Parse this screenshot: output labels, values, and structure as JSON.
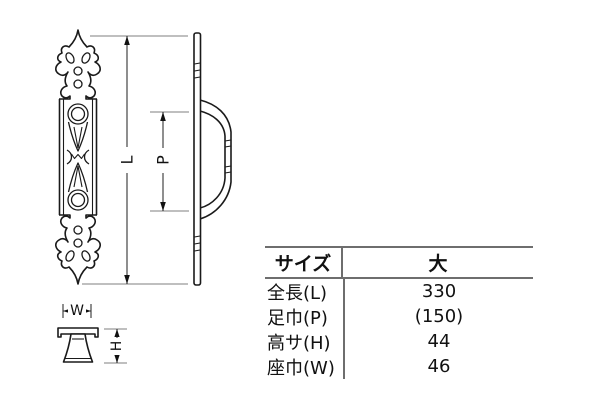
{
  "drawing": {
    "labels": {
      "length": "L",
      "pitch": "P",
      "width": "W",
      "height": "H"
    },
    "views": {
      "front": "front-view-ornate-plate",
      "side": "side-view-with-handle",
      "section": "cross-section-view"
    },
    "colors": {
      "ink": "#1a1a1a",
      "dimension_line": "#333333",
      "extension_line": "#999999",
      "table_rule": "#6e6e6e",
      "background": "#ffffff"
    }
  },
  "table": {
    "header": {
      "size_label": "サイズ",
      "size_value": "大"
    },
    "rows": [
      {
        "label": "全長(L)",
        "value": "330"
      },
      {
        "label": "足巾(P)",
        "value": "(150)"
      },
      {
        "label": "高サ(H)",
        "value": "44"
      },
      {
        "label": "座巾(W)",
        "value": "46"
      }
    ]
  }
}
